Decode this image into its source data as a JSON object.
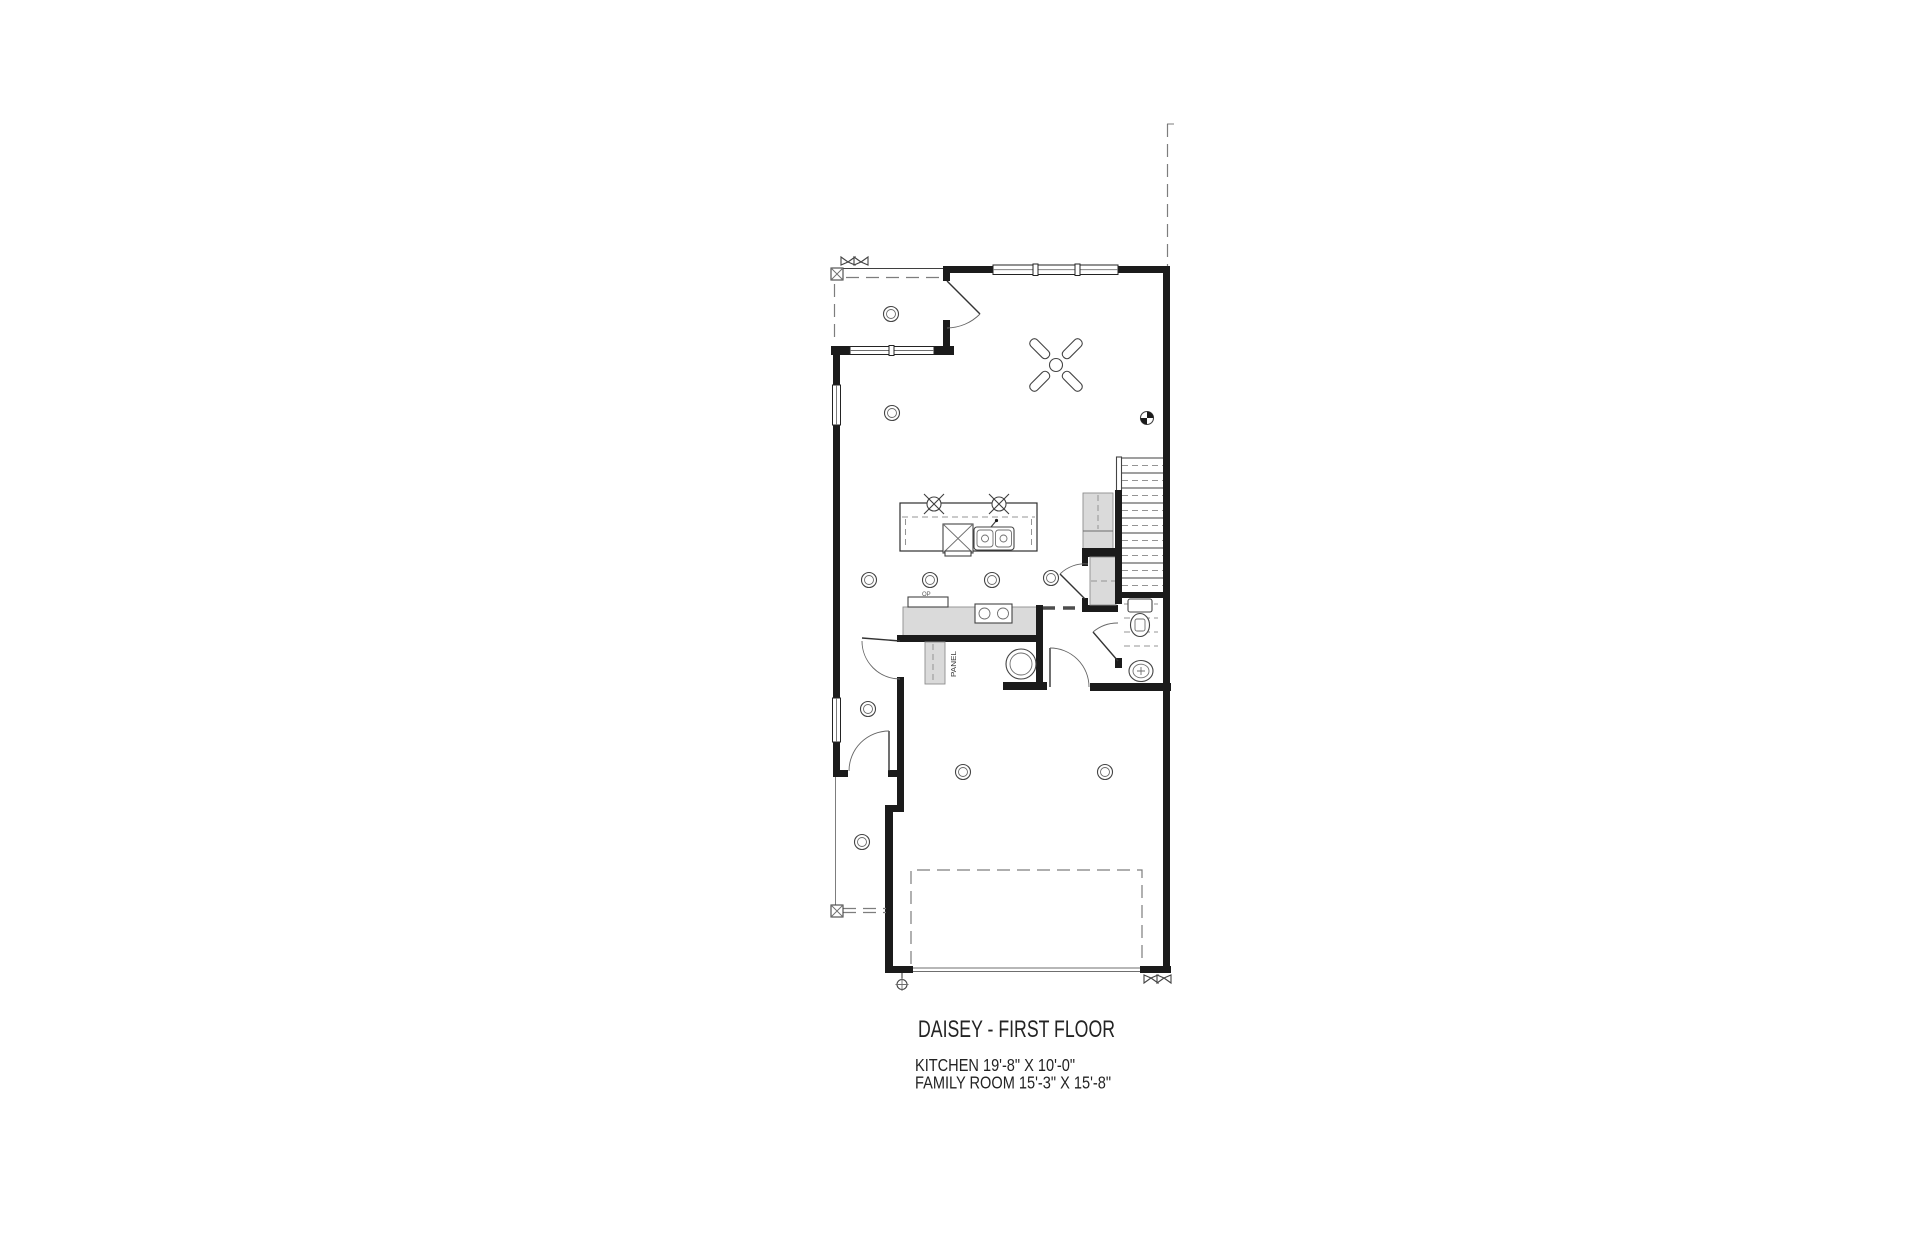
{
  "drawing": {
    "title": "DAISEY - FIRST FLOOR",
    "dimensions": {
      "kitchen": "KITCHEN 19'-8\" X 10'-0\"",
      "family_room": "FAMILY ROOM 15'-3\" X 15'-8\""
    },
    "labels": {
      "electrical_panel": "PANEL",
      "counter_note": "OP"
    }
  },
  "symbols": {
    "ceiling_light": "double circle",
    "pendant_light": "circle with X",
    "ceiling_fan": "hub circle with 4 diagonal blades",
    "exterior_sconce": "bowtie triangles",
    "hose_bib": "small circle with cross on stem",
    "datum_marker": "quartered circle",
    "column": "square with X",
    "dishwasher": "square with X",
    "garage_door_open_position": "dashed rectangle",
    "property_line": "vertical dashed line"
  },
  "colors": {
    "background": "#ffffff",
    "wall": "#1b1b1b",
    "thin_line": "#3f3f3f",
    "light_line": "#8a8a8a",
    "gray_fill": "#dadada",
    "text": "#232323"
  }
}
